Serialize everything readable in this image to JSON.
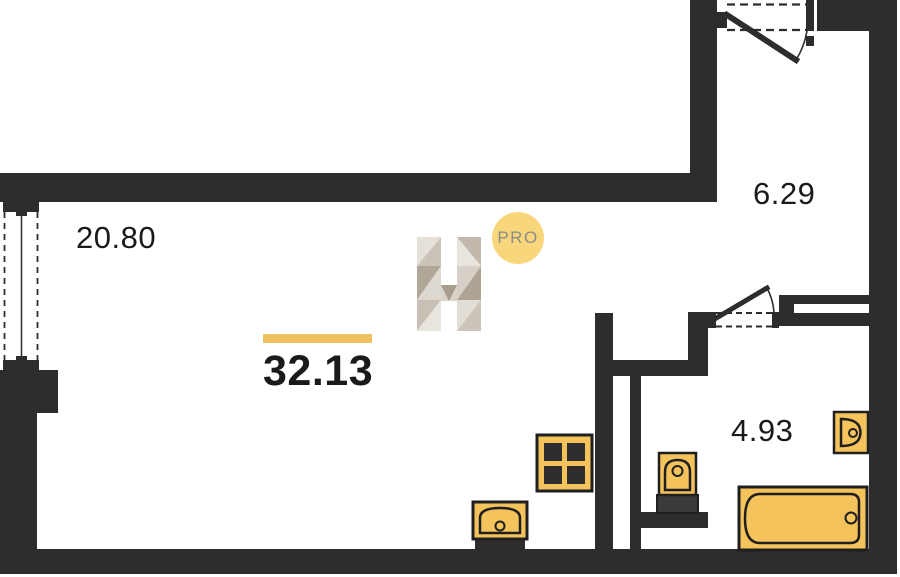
{
  "areas": {
    "total": "32.13",
    "living_room": "20.80",
    "hallway": "6.29",
    "bathroom": "4.93"
  },
  "watermark": {
    "logo_letter": "H",
    "badge_label": "PRO"
  },
  "colors": {
    "wall_dark": "#2D2D2D",
    "line_dark": "#1F1F1F",
    "fixture_yellow": "#F5C35C",
    "accent_bar_yellow": "#EFC05F",
    "badge_yellow": "#F8D77C",
    "badge_text_gray": "#8C8C86",
    "label_text": "#1A1A1A"
  },
  "fixtures": [
    {
      "name": "cooktop-icon"
    },
    {
      "name": "kitchen-sink-icon"
    },
    {
      "name": "toilet-icon"
    },
    {
      "name": "washbasin-icon"
    },
    {
      "name": "bathtub-icon"
    }
  ],
  "openings": [
    {
      "name": "entrance-door"
    },
    {
      "name": "bathroom-door"
    },
    {
      "name": "balcony-window"
    }
  ]
}
